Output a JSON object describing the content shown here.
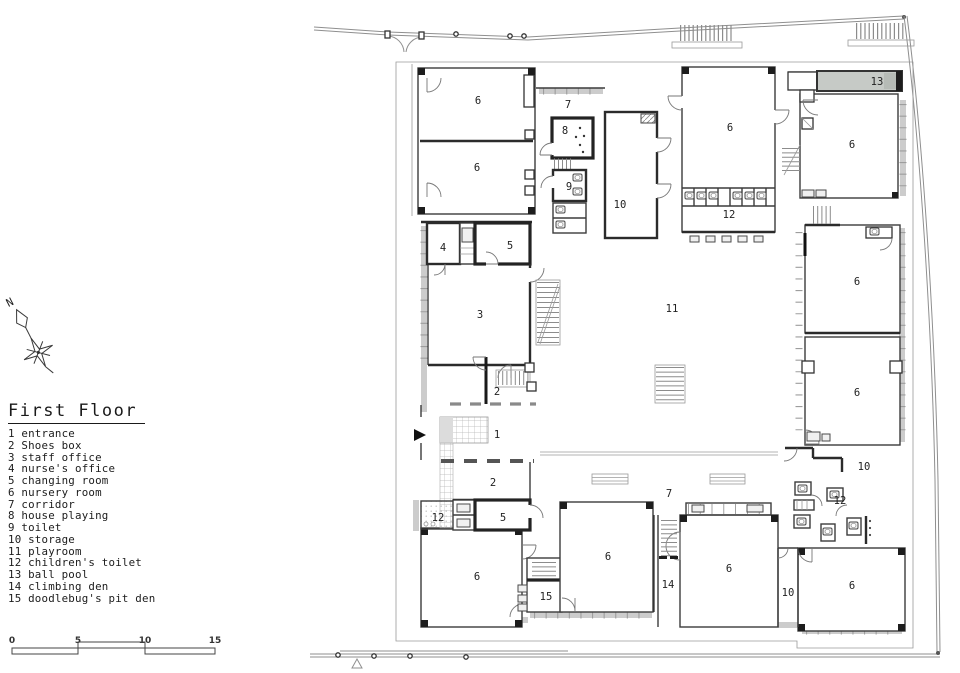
{
  "title": "First Floor",
  "compass": {
    "north_label": "N"
  },
  "legend": {
    "items": [
      "1 entrance",
      "2 Shoes box",
      "3 staff office",
      "4 nurse's office",
      "5 changing room",
      "6 nursery room",
      "7 corridor",
      "8 house playing",
      "9 toilet",
      "10 storage",
      "11 playroom",
      "12 children's toilet",
      "13 ball pool",
      "14 climbing den",
      "15 doodlebug's pit den"
    ]
  },
  "scale_bar": {
    "ticks": [
      "0",
      "5",
      "10",
      "15"
    ]
  },
  "plan": {
    "room_labels": [
      "6",
      "6",
      "7",
      "8",
      "9",
      "10",
      "6",
      "12",
      "13",
      "6",
      "4",
      "5",
      "3",
      "11",
      "6",
      "6",
      "2",
      "1",
      "2",
      "12",
      "5",
      "6",
      "15",
      "6",
      "7",
      "14",
      "6",
      "10",
      "10",
      "12",
      "6"
    ]
  },
  "colors": {
    "wall": "#2b2b2b",
    "wall_band": "#cccccc",
    "ball_pool_fill": "#c6cac6",
    "background": "#ffffff"
  }
}
